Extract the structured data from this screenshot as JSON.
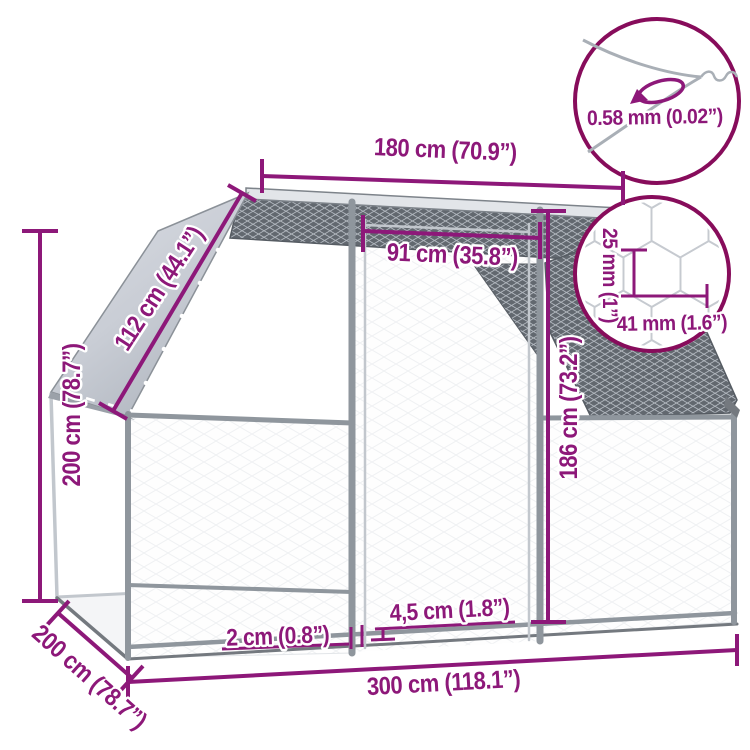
{
  "diagram_title": "Outdoor chicken cage dimension diagram",
  "colors": {
    "dimension_accent": "#8D1879",
    "detail_circle_border": "#870C5B",
    "frame_gray": "#8f969d",
    "mesh_dark": "#62686f",
    "roof_panel_gray": "#c9cdd5"
  },
  "labels": {
    "width_top": "180 cm (70.9”)",
    "wire_thickness": "0.58 mm (0.02”)",
    "door_width": "91 cm (35.8”)",
    "mesh_cell_height": "25 mm (1”)",
    "mesh_cell_width": "41 mm (1.6”)",
    "roof_slope": "112 cm (44.1”)",
    "total_height": "200 cm (78.7”)",
    "door_height": "186 cm (73.2”)",
    "rail_gap": "4,5 cm (1.8”)",
    "tube_gap": "2 cm (0.8”)",
    "total_width": "300 cm (118.1”)",
    "depth": "200 cm (78.7”)"
  }
}
